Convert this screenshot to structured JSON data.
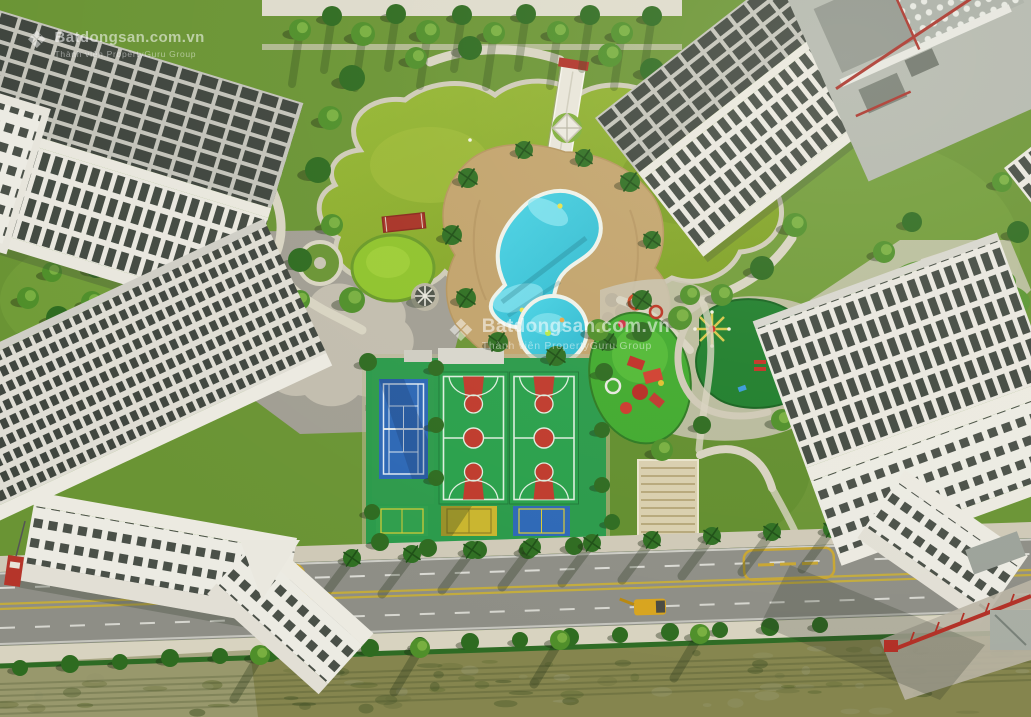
{
  "scene": {
    "type": "aerial-drone-photo",
    "subject": "High-rise residential complex with central landscaped park, pools and sports courts",
    "features": [
      "white apartment towers",
      "green lagoon pond",
      "elevated white walkway",
      "red foot bridge",
      "kidney-shaped swimming pool",
      "children's round pool",
      "palm-lined pool deck",
      "round lawn with gazebo",
      "gray plaza",
      "tennis court",
      "two basketball courts",
      "three badminton courts",
      "red playground",
      "spinner playground",
      "tree-lined avenue",
      "green construction fence",
      "vacant dirt lot"
    ]
  },
  "watermark": {
    "brand": "Batdongsan.com.vn",
    "tagline": "Thành viên PropertyGuru Group",
    "logo": "diamond-icon",
    "color": "#ffffff"
  },
  "road": {
    "center_line": "double-yellow",
    "marking_boxes": 2,
    "vehicle": "yellow-excavator"
  },
  "palette": {
    "lawn_green": "#6a9434",
    "pond_green": "#8aac2b",
    "pool_teal": "#3ecede",
    "deck_tan": "#c2a36c",
    "court_green": "#29a04b",
    "court_red": "#bf3a2c",
    "tennis_blue": "#2c67b5",
    "badminton_yellow": "#c9b52d",
    "building_white": "#e9e7df",
    "window_dark": "#434a42",
    "road_gray": "#8e8e86",
    "lane_yellow": "#c2ab3e",
    "accent_red": "#b23026",
    "dirt_olive": "#85854e"
  }
}
